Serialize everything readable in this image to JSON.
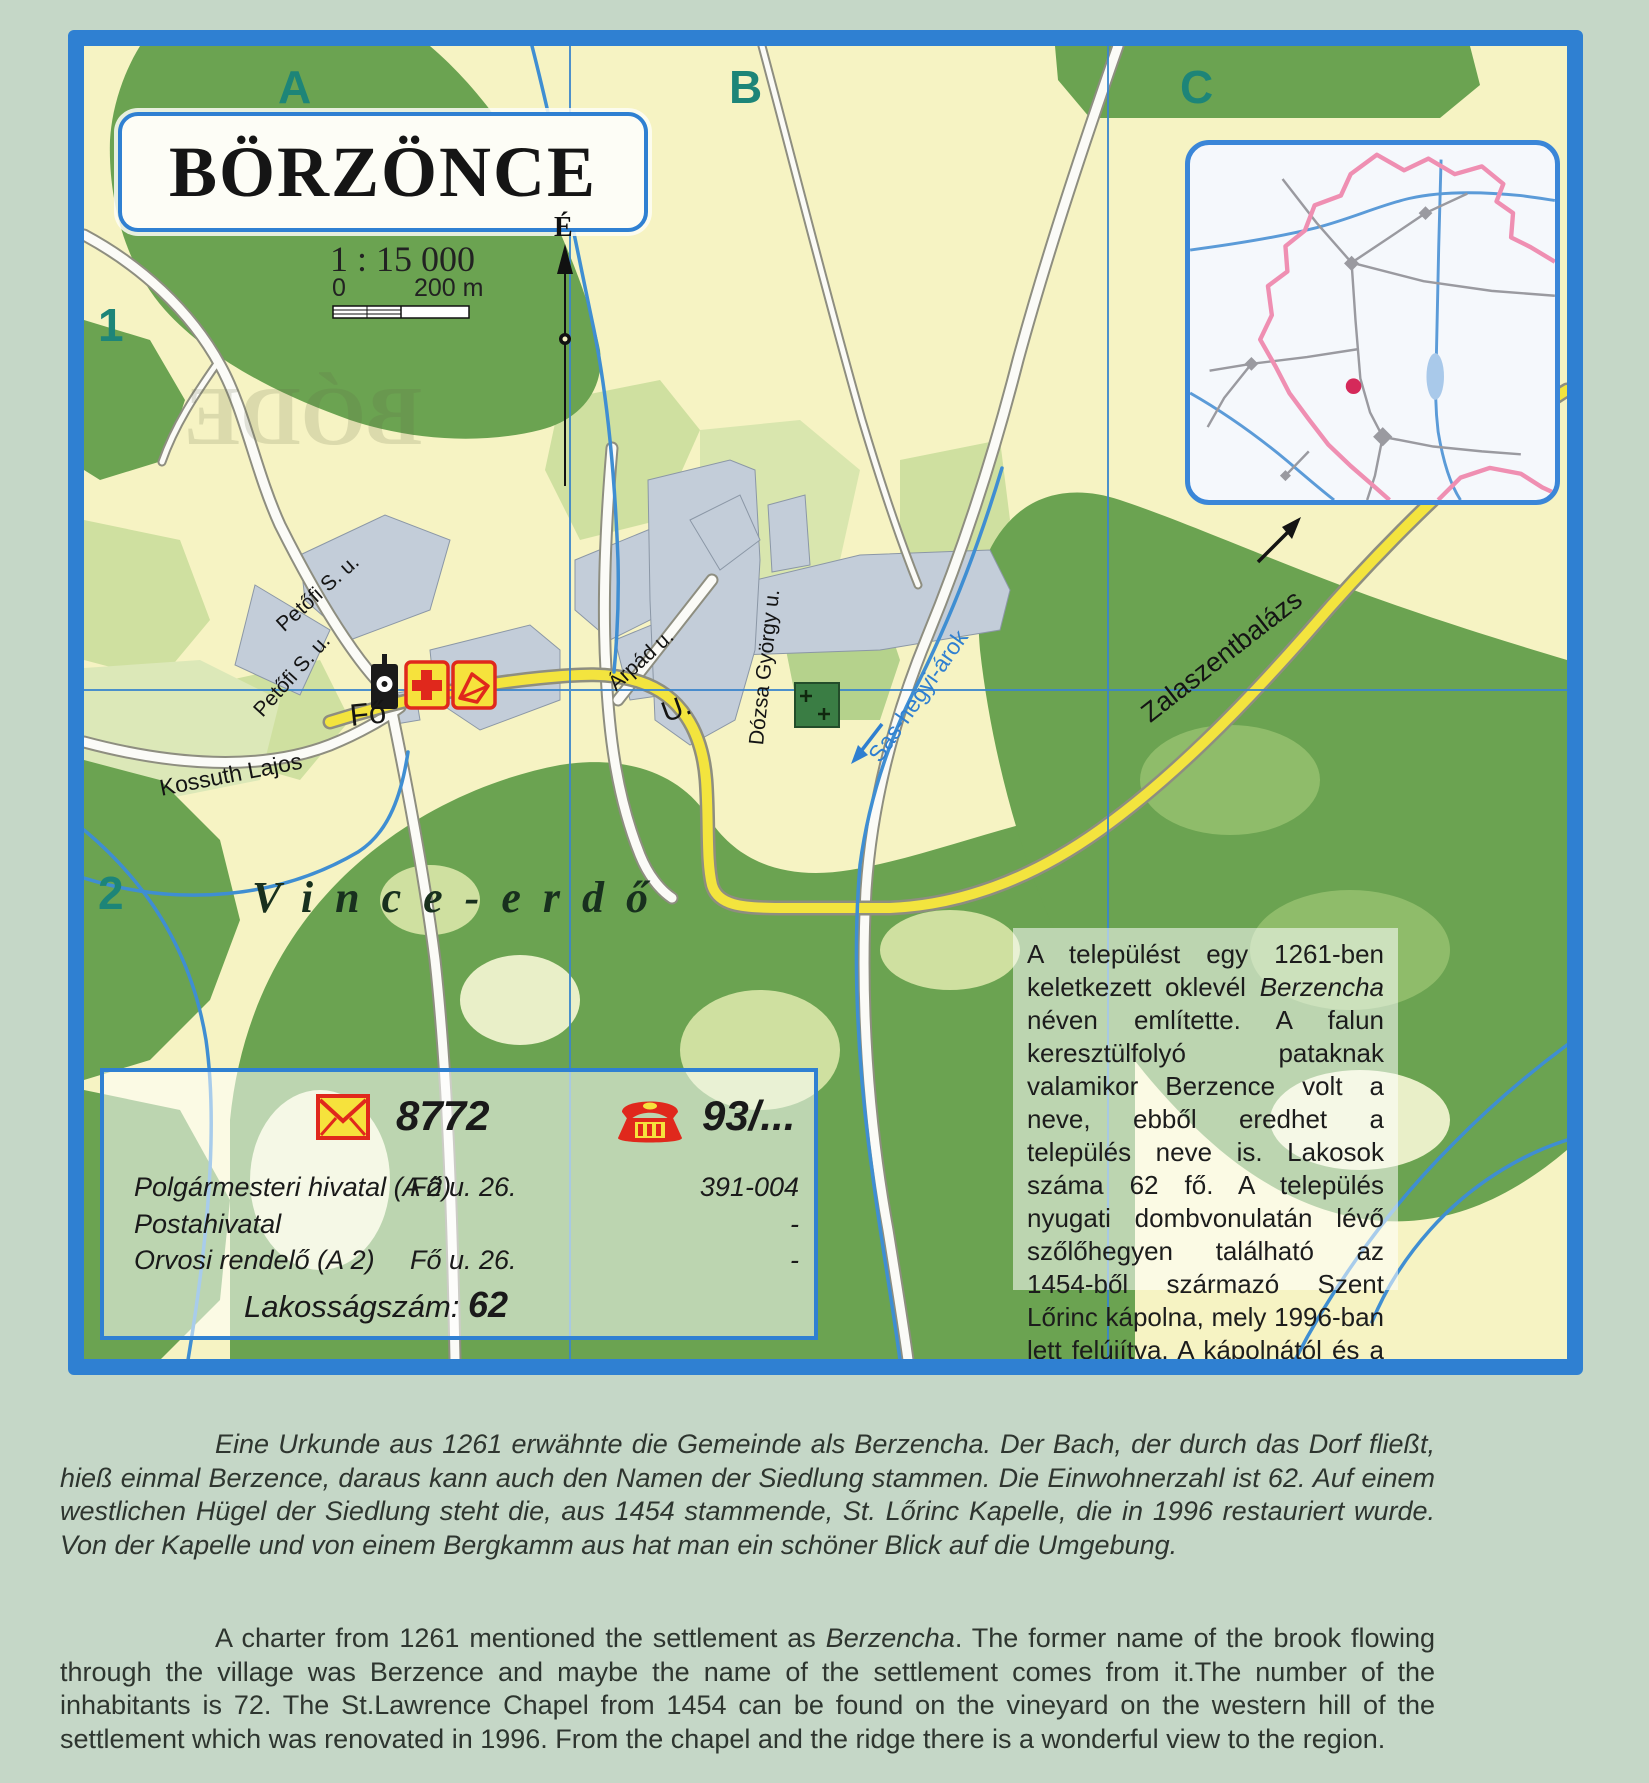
{
  "colors": {
    "page_bg": "#c5d7c7",
    "map_bg": "#f6f3c3",
    "frame_blue": "#2f80d2",
    "forest_green": "#6ba351",
    "field_green": "#cfe0a0",
    "builtup_gray": "#c3cdd9",
    "road_yellow": "#f3e43e",
    "water_blue": "#3f8ed2",
    "grid_label_teal": "#1d8578",
    "boundary_pink": "#ef8fb2",
    "icon_red": "#e0281c",
    "icon_yellow": "#f6e23c"
  },
  "map": {
    "title": "BÖRZÖNCE",
    "scale": {
      "ratio": "1 : 15 000",
      "zero": "0",
      "max": "200 m"
    },
    "north": "É",
    "grid": {
      "cols": [
        "A",
        "B",
        "C"
      ],
      "rows": [
        "1",
        "2"
      ]
    },
    "labels": {
      "petofi": "Petőfi S. u.",
      "fo": "Fő",
      "fo_u": "U.",
      "arpad": "Árpád u.",
      "dozsa": "Dózsa György u.",
      "kossuth": "Kossuth Lajos",
      "sas": "Sas-hegyi-árok",
      "zala": "Zalaszentbalázs",
      "vince": "Vince-erdő",
      "ghost": "BÓDE"
    }
  },
  "info_box": {
    "postal_code": "8772",
    "phone_code": "93/...",
    "rows": [
      {
        "name": "Polgármesteri hivatal (A 2)",
        "address": "Fő u. 26.",
        "phone": "391-004"
      },
      {
        "name": "Postahivatal",
        "address": "",
        "phone": "-"
      },
      {
        "name": "Orvosi rendelő (A 2)",
        "address": "Fő u. 26.",
        "phone": "-"
      }
    ],
    "population_label": "Lakosságszám:",
    "population_value": "62"
  },
  "description_hu": {
    "part1": "A települést egy 1261-ben keletkezett oklevél ",
    "name_italic": "Berzencha",
    "part2": " néven említette. A falun keresztülfolyó pataknak valamikor Berzence volt a neve, ebből eredhet a település neve is. Lakosok száma 62 fő. A település nyugati dombvonulatán lévő szőlőhegyen található az 1454-ből származó Szent Lőrinc kápolna, mely 1996-ban lett felújítva. A kápolnától és a hegy gerincéről szép panoráma nyílik a környékre."
  },
  "description_de": {
    "text": "Eine Urkunde aus 1261 erwähnte die Gemeinde als Berzencha. Der Bach, der durch das Dorf fließt, hieß einmal Berzence, daraus kann auch den Namen der Siedlung stammen. Die Einwohnerzahl ist 62. Auf einem westlichen Hügel der Siedlung steht die, aus 1454 stammende, St. Lőrinc Kapelle, die in 1996 restauriert wurde. Von der Kapelle und von einem Bergkamm aus hat man ein schöner Blick auf die Umgebung."
  },
  "description_en": {
    "part1": "A charter from 1261 mentioned the settlement as ",
    "name_italic": "Berzencha",
    "part2": ". The former name of the brook flowing through the village was Berzence and maybe the name of the settlement comes from it.The number of the inhabitants is 72. The St.Lawrence Chapel from 1454 can be found on the vineyard on the western hill of the settlement which was renovated in 1996. From the chapel and the ridge there is a wonderful view to the region."
  }
}
